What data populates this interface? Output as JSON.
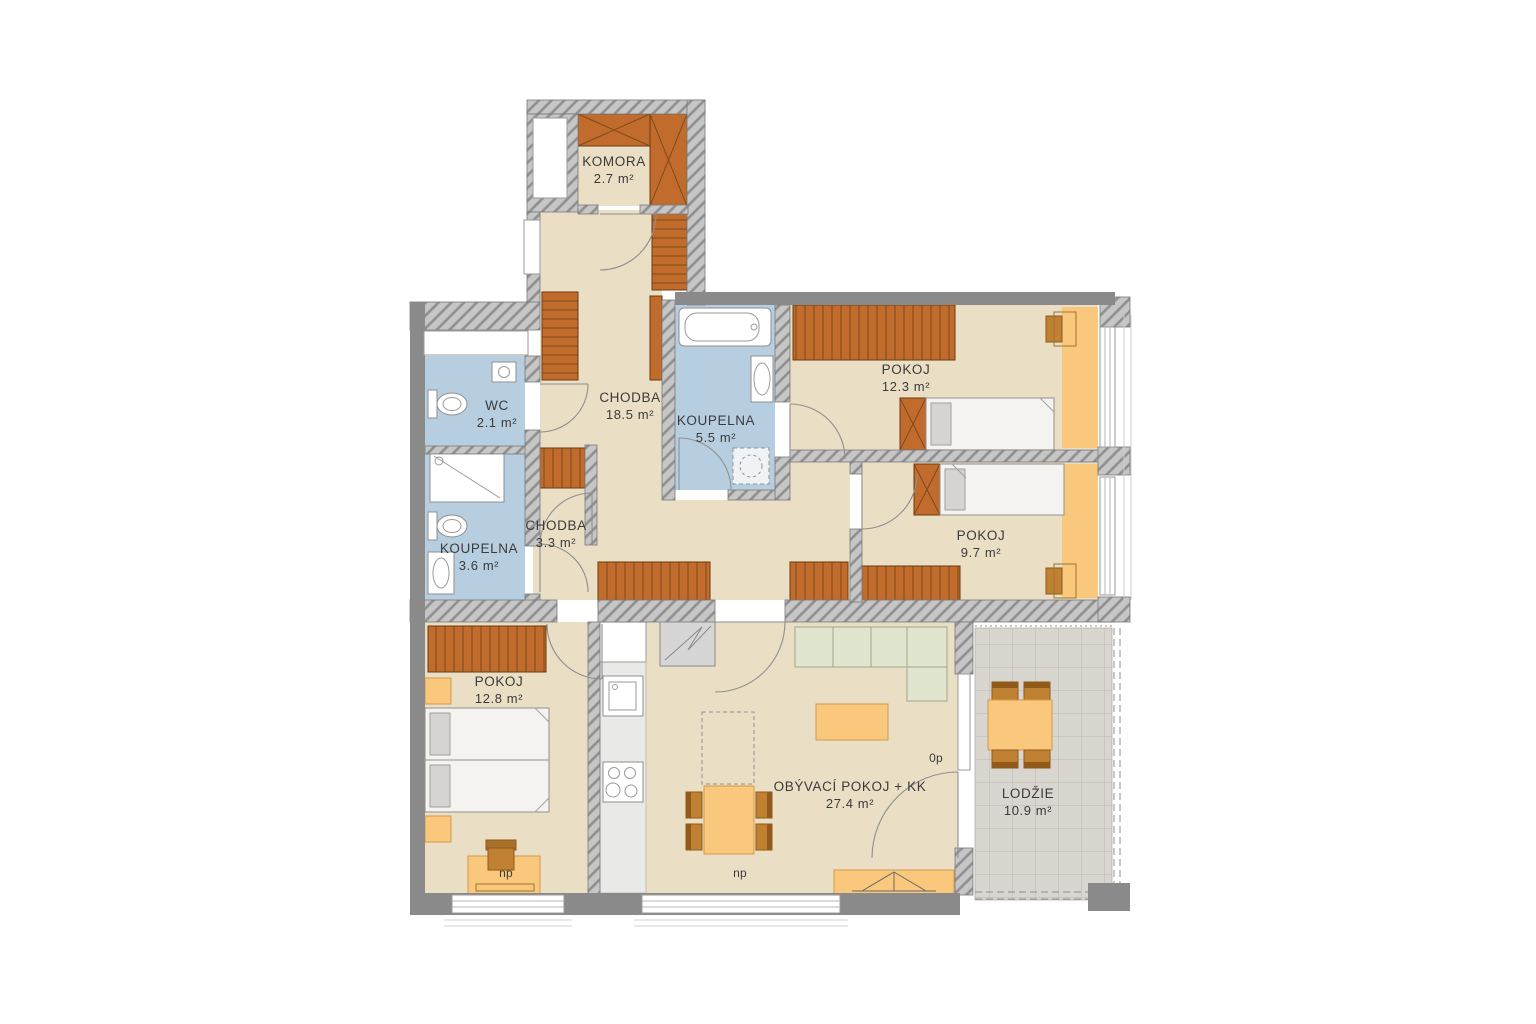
{
  "plan": {
    "rooms": {
      "komora": {
        "name": "KOMORA",
        "area": "2.7 m²"
      },
      "chodba_main": {
        "name": "CHODBA",
        "area": "18.5 m²"
      },
      "wc": {
        "name": "WC",
        "area": "2.1 m²"
      },
      "koupelna_main": {
        "name": "KOUPELNA",
        "area": "5.5 m²"
      },
      "pokoj_a": {
        "name": "POKOJ",
        "area": "12.3 m²"
      },
      "pokoj_b": {
        "name": "POKOJ",
        "area": "9.7 m²"
      },
      "koupelna_small": {
        "name": "KOUPELNA",
        "area": "3.6 m²"
      },
      "chodba_small": {
        "name": "CHODBA",
        "area": "3.3 m²"
      },
      "pokoj_c": {
        "name": "POKOJ",
        "area": "12.8 m²"
      },
      "living": {
        "name": "OBÝVACÍ POKOJ + KK",
        "area": "27.4 m²"
      },
      "lodzie": {
        "name": "LODŽIE",
        "area": "10.9 m²"
      }
    },
    "marks": {
      "np_bedroom": "np",
      "np_living": "np",
      "zero_p": "0p"
    },
    "colors": {
      "floor": "#eadfc4",
      "wet_floor": "#b7cee0",
      "wall": "#8a8a8a",
      "furniture_dark": "#c16c2d",
      "furniture_light": "#f9c87c",
      "sofa": "#e0e5cf",
      "loggia_floor": "#d9d5cf"
    }
  }
}
